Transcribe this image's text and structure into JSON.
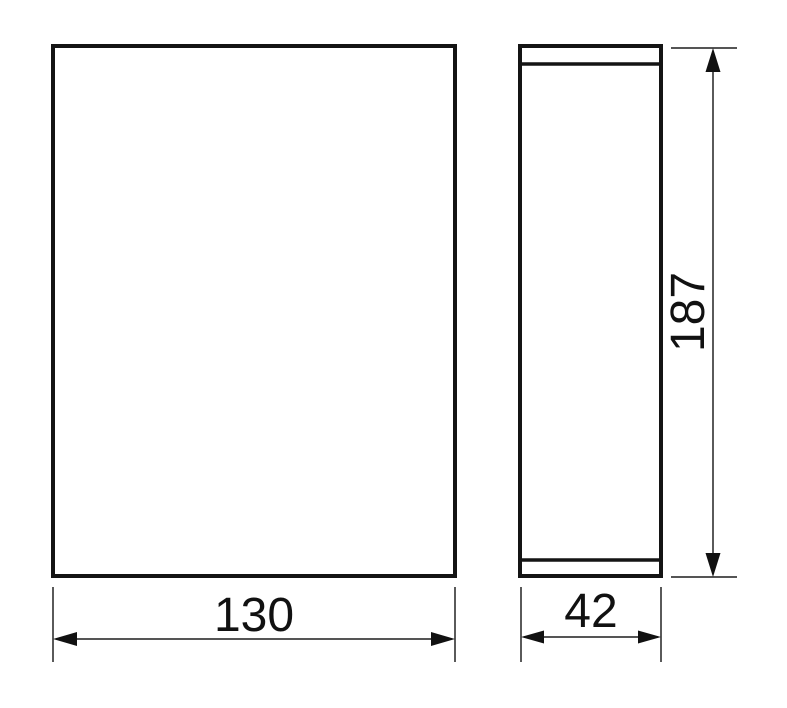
{
  "page": {
    "background": "#ffffff"
  },
  "drawing": {
    "description": "Two-view technical dimension drawing (front view and side view) with linear dimensions",
    "colors": {
      "outline": "#141414",
      "dimension_line": "#3d3d3d",
      "text": "#111111"
    },
    "dimensions": {
      "width": {
        "value": "130"
      },
      "depth": {
        "value": "42"
      },
      "height": {
        "value": "187"
      }
    }
  }
}
